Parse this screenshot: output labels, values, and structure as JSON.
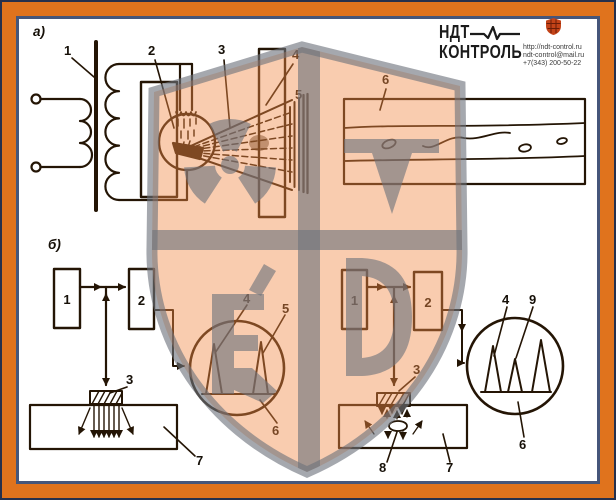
{
  "header": {
    "brand_top": "НДТ",
    "brand_bottom": "КОНТРОЛЬ",
    "website": "http://ndt-control.ru",
    "email": "ndt-control@mail.ru",
    "phone": "+7(343) 200-50-22"
  },
  "figure": {
    "section_a": "а)",
    "section_b": "б)",
    "a_labels": {
      "transformer": "1",
      "tube": "2",
      "beam": "3",
      "diaphragm": "4",
      "screen": "5",
      "object": "6"
    },
    "b_left_labels": {
      "generator": "1",
      "receiver": "2",
      "transducer": "3",
      "pulse_initial": "4",
      "pulse_bottom": "5",
      "screen": "6",
      "object": "7"
    },
    "b_right_labels": {
      "generator": "1",
      "receiver": "2",
      "transducer": "3",
      "pulse_initial": "4",
      "pulse_defect": "9",
      "screen": "6",
      "object": "7",
      "defect": "8"
    }
  },
  "colors": {
    "frame_orange": "#e0731d",
    "frame_line": "#46567a",
    "watermark_peach": "#f28c48",
    "watermark_gray": "#6e7280",
    "logo_shield_red": "#c34318",
    "ink": "#241505"
  }
}
